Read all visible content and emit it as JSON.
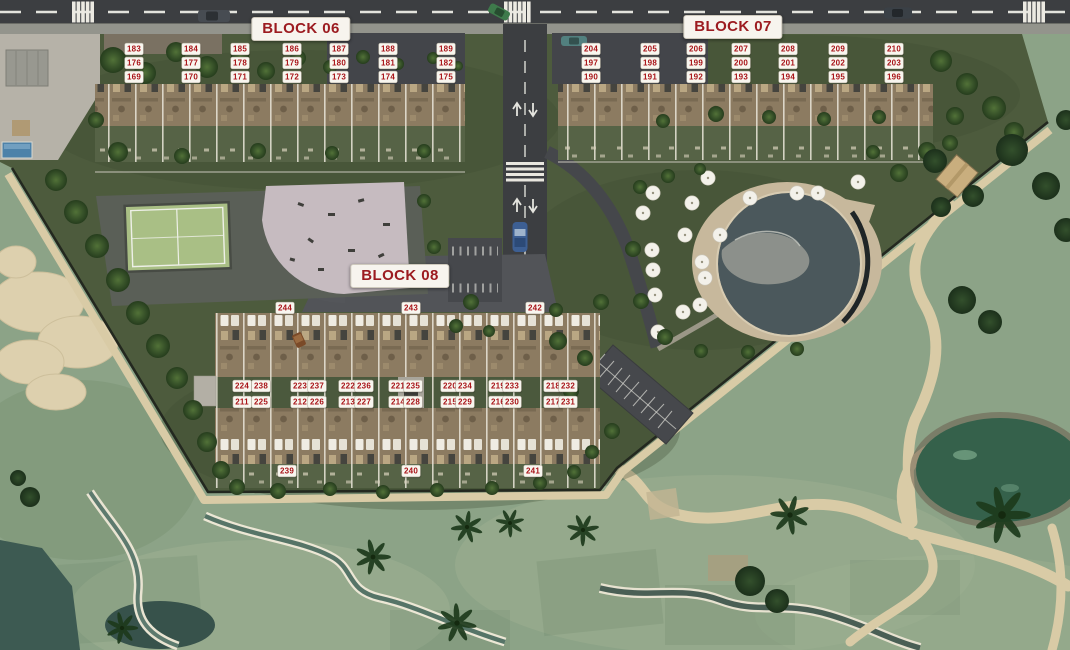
{
  "palette": {
    "label_red": "#a81318",
    "block_label_red": "#9c1b20",
    "label_bg": "#f8f6ef",
    "road_asphalt": "#3c3e41",
    "development_grass": "#4d5b3d",
    "golf_grass": "#8ca387",
    "sand_bunker": "#ddd0ae",
    "cart_path_tan": "#d9cba6",
    "pool_water": "#4b585c"
  },
  "blocks": [
    {
      "id": "block-06",
      "label": "BLOCK 06",
      "label_x": 301,
      "label_y": 29,
      "rows": [
        {
          "y": 49,
          "xs": [
            134,
            191,
            240,
            292,
            339,
            388,
            446
          ],
          "units": [
            "183",
            "184",
            "185",
            "186",
            "187",
            "188",
            "189"
          ]
        },
        {
          "y": 63,
          "xs": [
            134,
            191,
            240,
            292,
            339,
            388,
            446
          ],
          "units": [
            "176",
            "177",
            "178",
            "179",
            "180",
            "181",
            "182"
          ]
        },
        {
          "y": 77,
          "xs": [
            134,
            191,
            240,
            292,
            339,
            388,
            446
          ],
          "units": [
            "169",
            "170",
            "171",
            "172",
            "173",
            "174",
            "175"
          ]
        }
      ]
    },
    {
      "id": "block-07",
      "label": "BLOCK 07",
      "label_x": 733,
      "label_y": 27,
      "rows": [
        {
          "y": 49,
          "xs": [
            591,
            650,
            696,
            741,
            788,
            838,
            894
          ],
          "units": [
            "204",
            "205",
            "206",
            "207",
            "208",
            "209",
            "210"
          ]
        },
        {
          "y": 63,
          "xs": [
            591,
            650,
            696,
            741,
            788,
            838,
            894
          ],
          "units": [
            "197",
            "198",
            "199",
            "200",
            "201",
            "202",
            "203"
          ]
        },
        {
          "y": 77,
          "xs": [
            591,
            650,
            696,
            741,
            788,
            838,
            894
          ],
          "units": [
            "190",
            "191",
            "192",
            "193",
            "194",
            "195",
            "196"
          ]
        }
      ]
    },
    {
      "id": "block-08",
      "label": "BLOCK 08",
      "label_x": 400,
      "label_y": 276,
      "rows": [
        {
          "y": 308,
          "xs": [
            285,
            411,
            535
          ],
          "units": [
            "244",
            "243",
            "242"
          ]
        },
        {
          "y": 386,
          "xs": [
            242,
            261,
            300,
            317,
            348,
            364,
            398,
            413,
            450,
            465,
            498,
            512,
            553,
            568
          ],
          "units": [
            "224",
            "238",
            "223",
            "237",
            "222",
            "236",
            "221",
            "235",
            "220",
            "234",
            "219",
            "233",
            "218",
            "232"
          ]
        },
        {
          "y": 402,
          "xs": [
            242,
            261,
            300,
            317,
            348,
            364,
            398,
            413,
            450,
            465,
            498,
            512,
            553,
            568
          ],
          "units": [
            "211",
            "225",
            "212",
            "226",
            "213",
            "227",
            "214",
            "228",
            "215",
            "229",
            "216",
            "230",
            "217",
            "231"
          ]
        },
        {
          "y": 471,
          "xs": [
            287,
            411,
            533
          ],
          "units": [
            "239",
            "240",
            "241"
          ]
        }
      ]
    }
  ]
}
